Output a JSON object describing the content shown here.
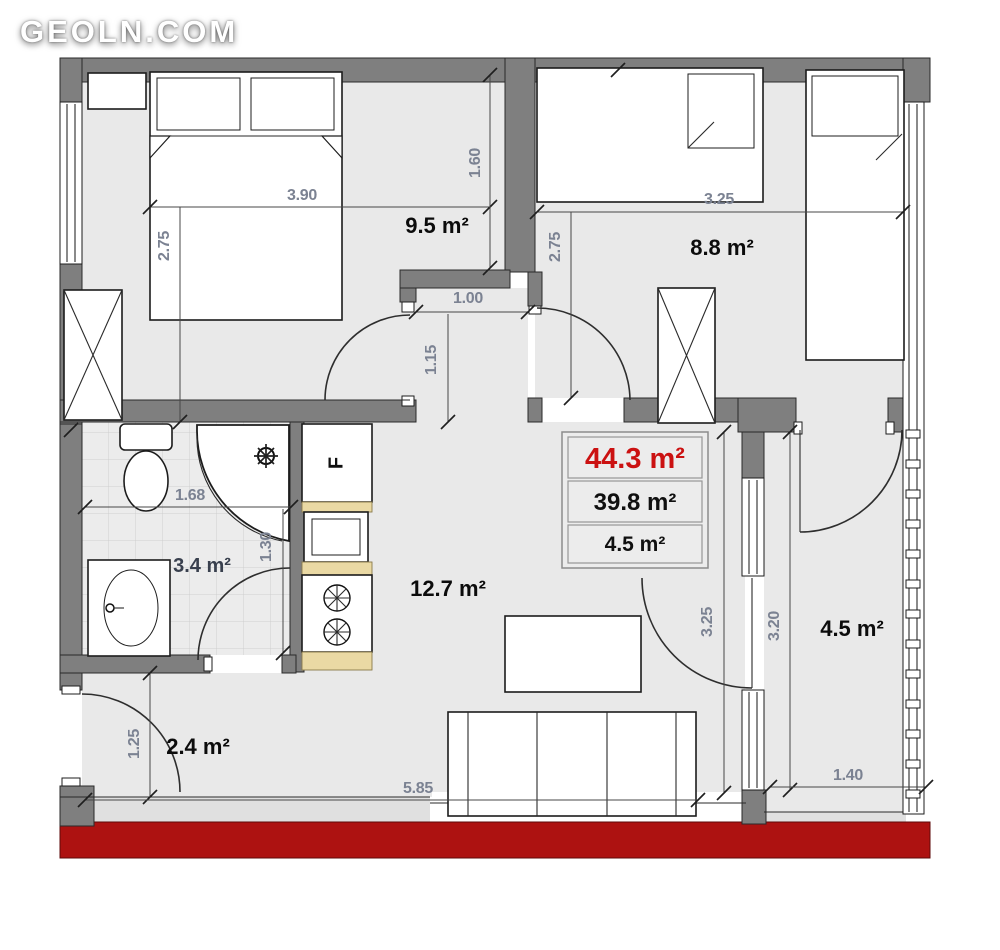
{
  "logo": {
    "text": "GEOLN.COM"
  },
  "summary": {
    "total_area": "44.3 m²",
    "living_area": "39.8 m²",
    "extra_area": "4.5 m²"
  },
  "rooms": {
    "bedroom1": {
      "area_label": "9.5 m²"
    },
    "bedroom2": {
      "area_label": "8.8 m²"
    },
    "bathroom": {
      "area_label": "3.4 m²"
    },
    "living": {
      "area_label": "12.7 m²"
    },
    "hall": {
      "area_label": "2.4 m²"
    },
    "balcony": {
      "area_label": "4.5 m²"
    }
  },
  "dimensions": {
    "bed1_width": "3.90",
    "bed1_height": "2.75",
    "bed1_right": "1.60",
    "bed2_width": "3.25",
    "bed2_height": "2.75",
    "niche_width": "1.00",
    "niche_height": "1.15",
    "bath_width": "1.68",
    "bath_height": "1.30",
    "living_height": "3.25",
    "balcony_height": "3.20",
    "hall_height": "1.25",
    "bottom_width": "5.85",
    "balcony_width": "1.40"
  },
  "kitchen": {
    "fridge_label": "F"
  },
  "colors": {
    "wall": "#7f7f7f",
    "floor": "#e9e9e9",
    "red_band": "#ad1211",
    "accent_red": "#cb1111",
    "dim_text": "#7b8292",
    "wood": "#ead9a4",
    "ink": "#0c0c0c"
  }
}
